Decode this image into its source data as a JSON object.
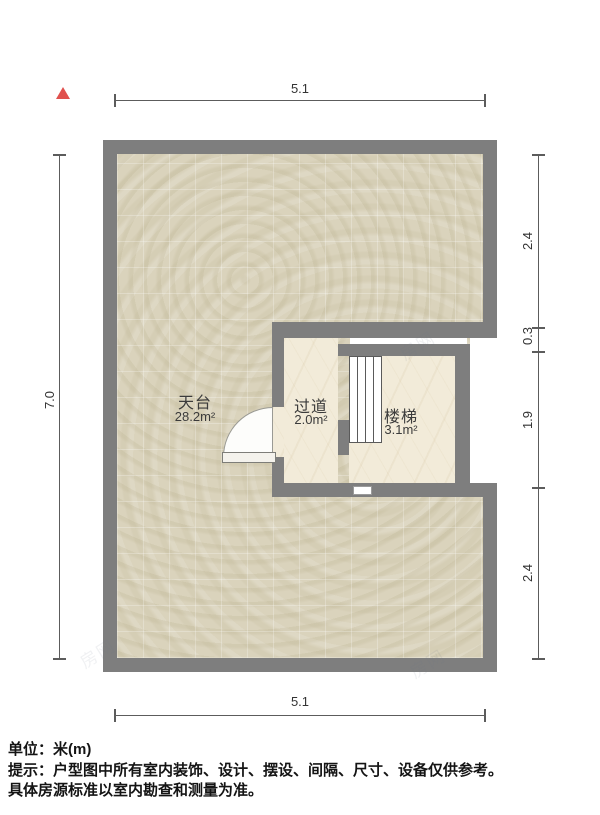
{
  "compass": {
    "icon": "north-triangle-icon",
    "color": "#e0514e"
  },
  "dimensions": {
    "top": "5.1",
    "bottom": "5.1",
    "left": "7.0",
    "right": [
      "2.4",
      "0.3",
      "1.9",
      "2.4"
    ]
  },
  "rooms": [
    {
      "name": "天台",
      "area": "28.2m²"
    },
    {
      "name": "过道",
      "area": "2.0m²"
    },
    {
      "name": "楼梯",
      "area": "3.1m²"
    }
  ],
  "footer": {
    "unit": "单位：米(m)",
    "tip": "提示：户型图中所有室内装饰、设计、摆设、间隔、尺寸、设备仅供参考。",
    "tip2": "具体房源标准以室内勘查和测量为准。"
  },
  "watermark": "房网",
  "colors": {
    "wall": "#7e7e7e",
    "terrace_floor": "#dad3bc",
    "room_floor": "#f2ebd9",
    "north_arrow": "#e0514e",
    "dimension_text": "#333333"
  }
}
